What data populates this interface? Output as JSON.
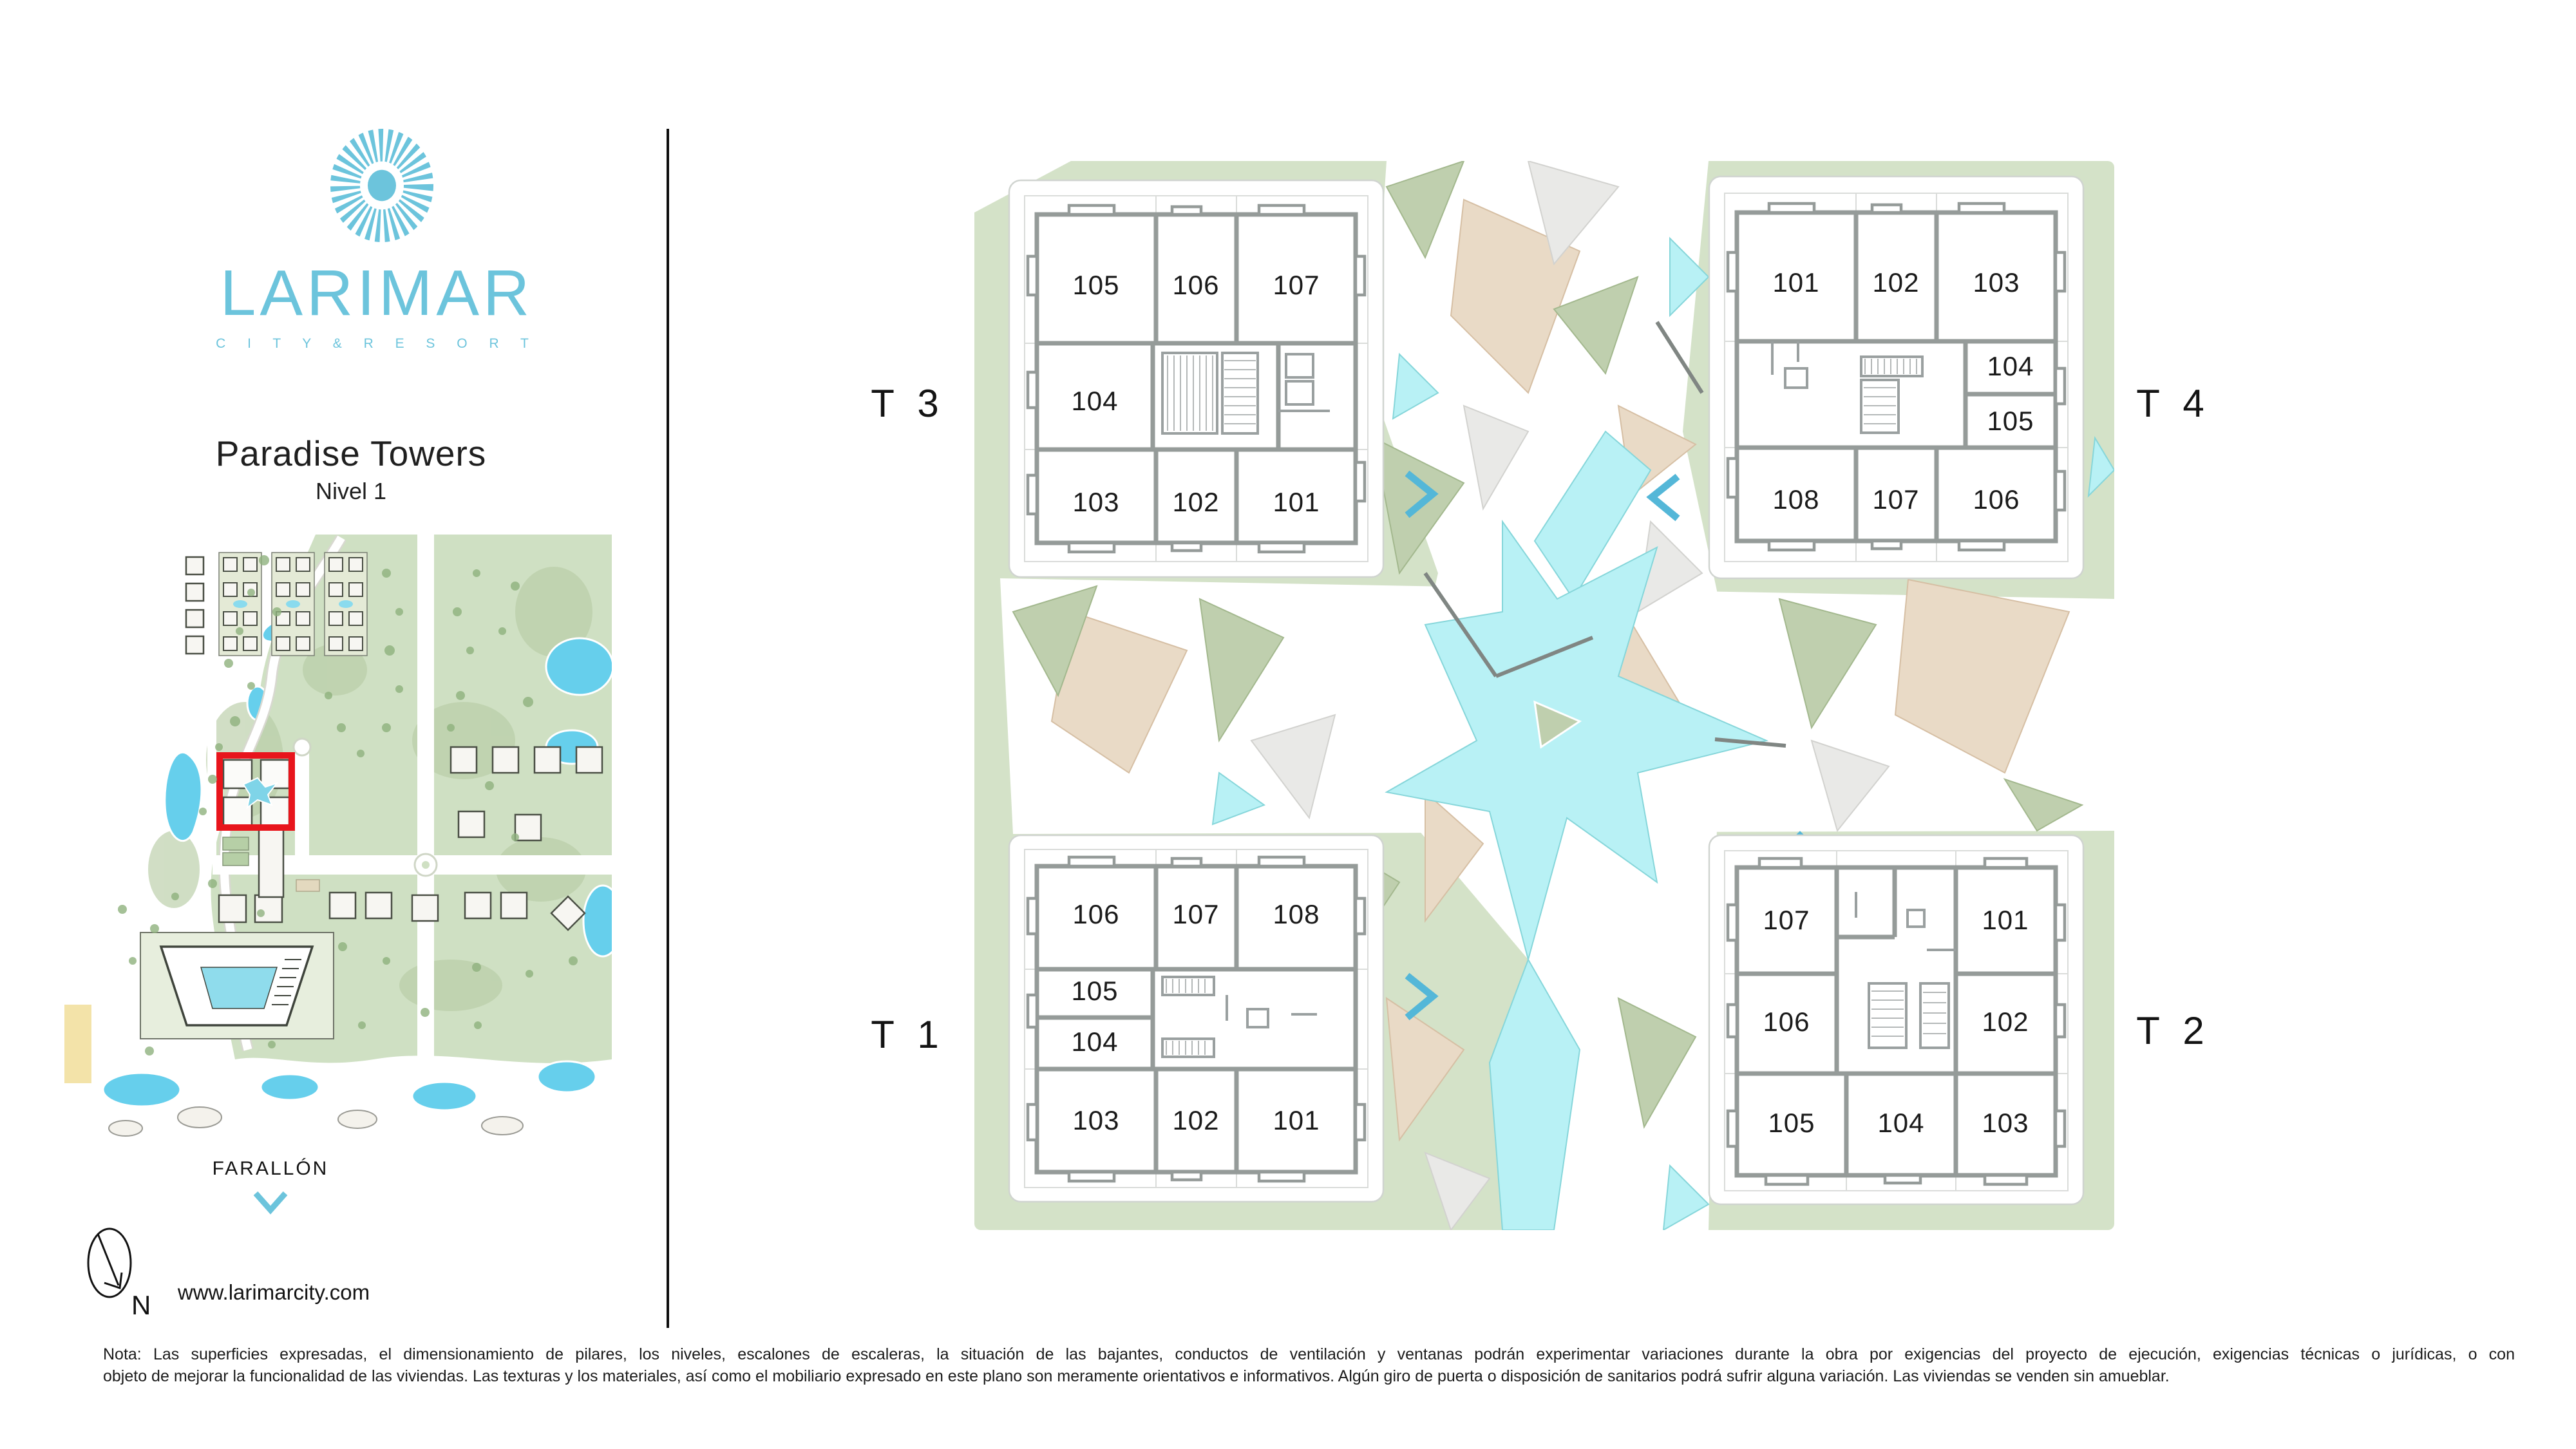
{
  "brand": {
    "name": "LARIMAR",
    "tagline": "C I T Y   &   R E S O R T",
    "website": "www.larimarcity.com"
  },
  "header": {
    "title": "Paradise Towers",
    "subtitle": "Nivel 1"
  },
  "minimap": {
    "area_label": "FARALLÓN",
    "compass_north": "N",
    "highlight_color": "#e8151c"
  },
  "towers": [
    {
      "label": "T 3",
      "units": [
        "105",
        "106",
        "107",
        "104",
        "103",
        "102",
        "101"
      ]
    },
    {
      "label": "T 4",
      "units": [
        "101",
        "102",
        "103",
        "104",
        "105",
        "108",
        "107",
        "106"
      ]
    },
    {
      "label": "T 1",
      "units": [
        "106",
        "107",
        "108",
        "105",
        "104",
        "103",
        "102",
        "101"
      ]
    },
    {
      "label": "T 2",
      "units": [
        "107",
        "101",
        "106",
        "102",
        "105",
        "104",
        "103"
      ]
    }
  ],
  "note": {
    "line1": "Nota: Las superficies expresadas, el dimensionamiento de pilares, los niveles, escalones de escaleras, la situación de las bajantes, conductos de ventilación y ventanas podrán experimentar variaciones durante la obra por exigencias del proyecto de ejecución, exigencias técnicas o jurídicas, o con",
    "line2": "objeto de mejorar la funcionalidad de las viviendas. Las texturas y los materiales, así como el mobiliario expresado en este plano son meramente orientativos e informativos. Algún giro de puerta o disposición de sanitarios podrá sufrir alguna variación. Las viviendas se venden sin amueblar."
  },
  "colors": {
    "accent": "#6cc4dc",
    "chevron": "#54b7d8",
    "plan_green": "#d4e2c8",
    "water": "#b8f1f5",
    "sand": "#e9dac6",
    "wall_gray": "#959b99"
  }
}
